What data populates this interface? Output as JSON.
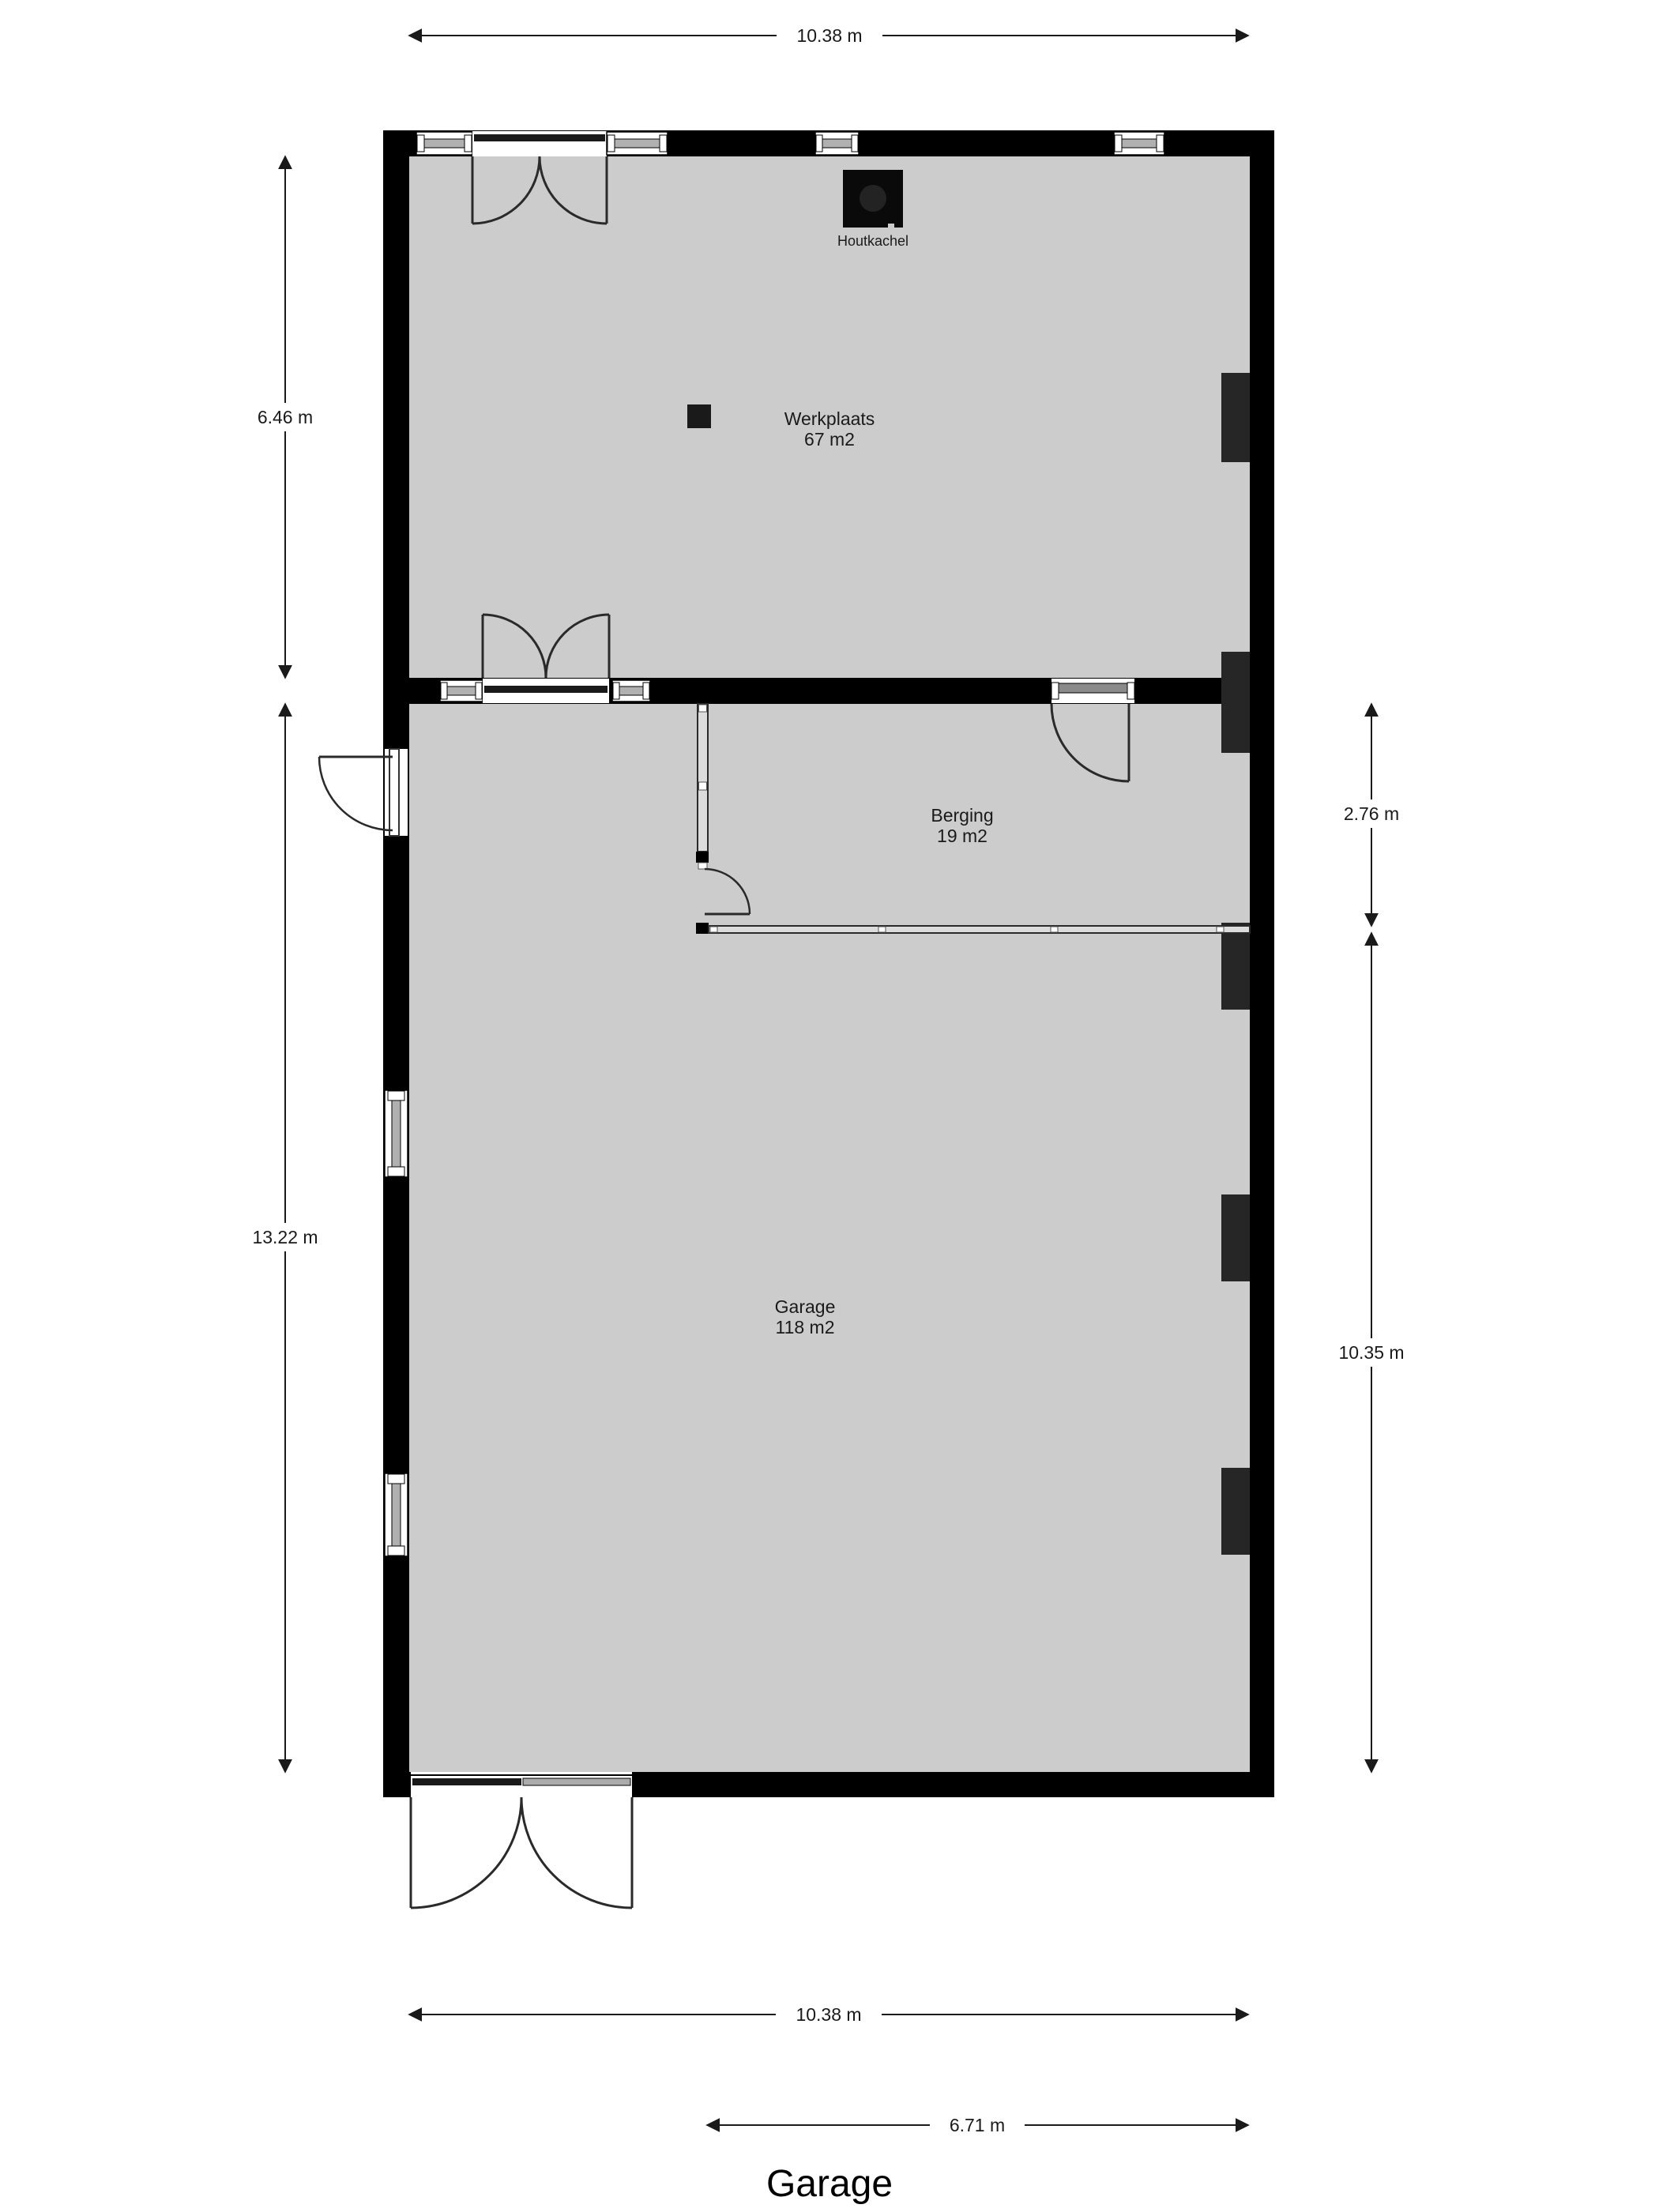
{
  "title": "Garage",
  "rooms": [
    {
      "name": "Werkplaats",
      "area": "67 m2"
    },
    {
      "name": "Berging",
      "area": "19 m2"
    },
    {
      "name": "Garage",
      "area": "118 m2"
    }
  ],
  "features": {
    "stove_label": "Houtkachel"
  },
  "dimensions": {
    "top": "10.38 m",
    "left_upper": "6.46 m",
    "left_lower": "13.22 m",
    "right_upper": "2.76 m",
    "right_lower": "10.35 m",
    "bottom": "10.38 m",
    "bottom_inner": "6.71 m"
  },
  "colors": {
    "wall": "#000000",
    "floor": "#cccccc",
    "pillar": "#262626",
    "stove": "#0a0a0a",
    "background": "#ffffff"
  }
}
